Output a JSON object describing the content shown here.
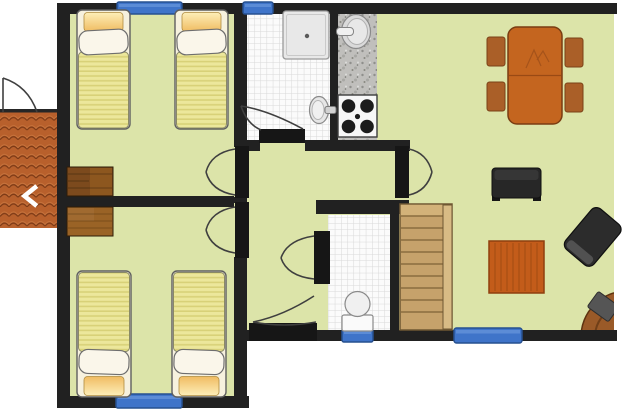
{
  "gallery": {
    "prev_arrow": "‹"
  },
  "colors": {
    "outside": "#ffffff",
    "floor": "#dce4a9",
    "wall": "#212121",
    "door_leaf": "#161616",
    "swing": "#3f3f3f",
    "tile_bg": "#fbfbfb",
    "tile_line": "#d8d8d8",
    "granite": "#c0bfbc",
    "window_fill": "#3f74c9",
    "window_border": "#27508f",
    "roof": "#b8602c",
    "roof_line": "#7d3a16",
    "roof_highlight": "#d98a50",
    "bed_frame": "#f6f1de",
    "bed_blanket": "#ece79b",
    "bed_stripe": "#d8d178",
    "pillow": "#faf6ea",
    "cushion_light": "#fdeeb8",
    "cushion_dark": "#f0bc62",
    "wardrobe_dark": "#7c4a1d",
    "wardrobe_light": "#9a6326",
    "stairs": "#c6a26b",
    "stairs_rail": "#d8bb85",
    "stairs_line": "#8a6d3f",
    "wood_table": "#c4651f",
    "wood_chair": "#aa5f28",
    "wood_coffee": "#c35c1a",
    "wood_round": "#9a5a28",
    "dark_furniture": "#272727",
    "fixture_fill": "#e8e8e8",
    "fixture_stroke": "#8a8a8a",
    "arrow_white": "#ffffff"
  },
  "floor_plan": {
    "type": "apartment floor plan",
    "rooms": [
      {
        "id": "bedroom-top",
        "contents": [
          "single bed",
          "single bed",
          "wardrobe"
        ],
        "windows": 1
      },
      {
        "id": "bedroom-bottom",
        "contents": [
          "single bed",
          "single bed",
          "wardrobe"
        ],
        "windows": 1
      },
      {
        "id": "bathroom",
        "contents": [
          "shower tray",
          "washbasin"
        ],
        "windows": 1
      },
      {
        "id": "kitchen-niche",
        "contents": [
          "kitchen sink",
          "stove 4 burners"
        ],
        "windows": 0
      },
      {
        "id": "wc",
        "contents": [
          "toilet"
        ],
        "windows": 1
      },
      {
        "id": "hallway",
        "contents": [],
        "windows": 0
      },
      {
        "id": "living-dining-room",
        "contents": [
          "dining table",
          "4 dining chairs",
          "tv bench",
          "coffee table",
          "armchair",
          "corner round table",
          "staircase"
        ],
        "windows": 1
      },
      {
        "id": "entrance-porch",
        "contents": [
          "tiled roof canopy",
          "entrance door"
        ],
        "windows": 0
      }
    ],
    "window_count": 5,
    "door_count": 7
  }
}
